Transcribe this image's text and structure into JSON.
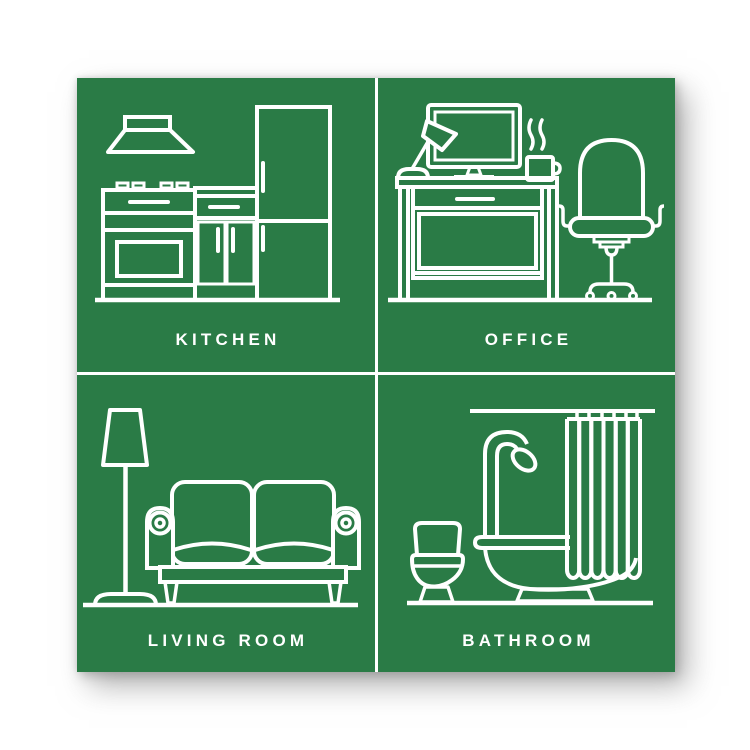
{
  "poster": {
    "background_color": "#ffffff",
    "card_color": "#2a7b46",
    "line_color": "#ffffff",
    "quadrants": [
      {
        "id": "kitchen",
        "label": "KITCHEN",
        "icon": "kitchen-illustration"
      },
      {
        "id": "office",
        "label": "OFFICE",
        "icon": "office-illustration"
      },
      {
        "id": "living-room",
        "label": "LIVING ROOM",
        "icon": "living-room-illustration"
      },
      {
        "id": "bathroom",
        "label": "BATHROOM",
        "icon": "bathroom-illustration"
      }
    ]
  }
}
